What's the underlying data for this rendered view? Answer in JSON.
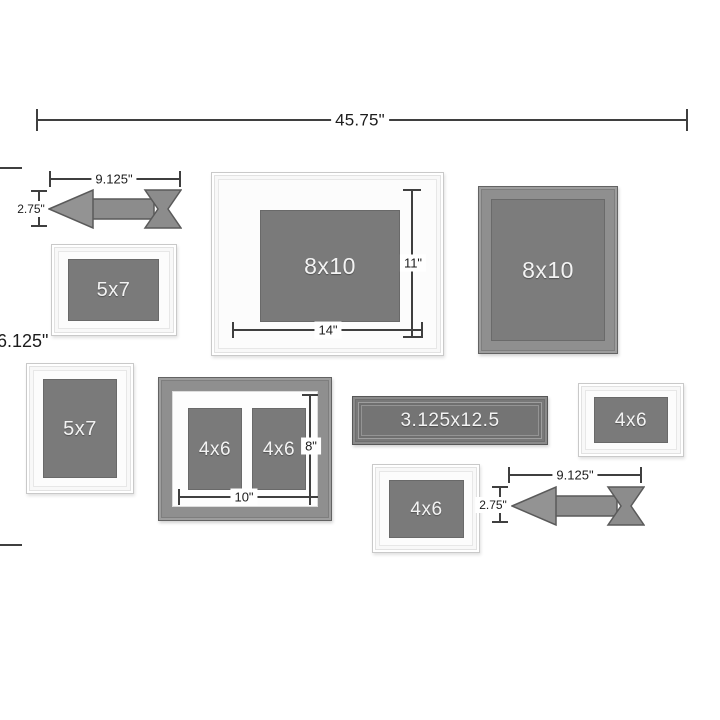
{
  "diagram": {
    "description": "gallery-wall-frame-set-dimension-diagram"
  },
  "dims": {
    "overall_width": "45.75\"",
    "overall_height": "6.125\"",
    "arrow_top_width": "9.125\"",
    "arrow_top_height": "2.75\"",
    "mat_opening_height": "11\"",
    "mat_opening_width": "14\"",
    "collage_opening_height": "8\"",
    "collage_opening_width": "10\"",
    "arrow_bottom_width": "9.125\"",
    "arrow_bottom_height": "2.75\""
  },
  "frames": {
    "f_5x7_landscape": "5x7",
    "f_8x10_matted": "8x10",
    "f_8x10_gray": "8x10",
    "f_5x7_portrait": "5x7",
    "f_collage_left": "4x6",
    "f_collage_right": "4x6",
    "f_ledge": "3.125x12.5",
    "f_4x6_right": "4x6",
    "f_4x6_bottom": "4x6"
  },
  "colors": {
    "dim_line": "#3f3f3f",
    "frame_gray": "#8f8f8f",
    "opening_gray": "#7a7a7a",
    "arrow_fill": "#8c8c8c",
    "arrow_stroke": "#5a5a5a",
    "white_frame": "#fcfcfc"
  }
}
